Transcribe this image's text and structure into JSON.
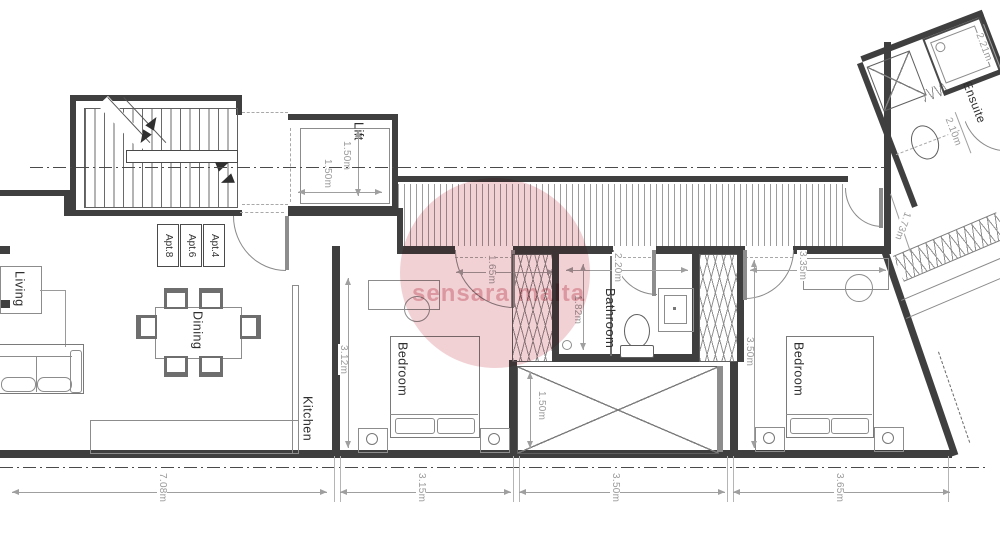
{
  "labels": {
    "lift": "Lift",
    "living": "Living",
    "dining": "Dining",
    "kitchen": "Kitchen",
    "bedroom1": "Bedroom",
    "bedroom2": "Bedroom",
    "bathroom": "Bathroom",
    "ensuite": "Ensuite",
    "apt": [
      "Apt.8",
      "Apt.6",
      "Apt.4"
    ]
  },
  "dimensions": {
    "lift_v": "1.50m",
    "lift_h": "1.50m",
    "bed1_door": "1.65m",
    "bed1_depth": "3.12m",
    "bath_width": "2.20m",
    "shower_depth": "1.82m",
    "void_width": "1.50m",
    "bed2_top": "3.35m",
    "bed2_depth": "3.50m",
    "ensuite_a": "2.21m",
    "ensuite_b": "2.10m",
    "terrace": "1.73m",
    "bottom": [
      "7.08m",
      "3.15m",
      "3.50m",
      "3.65m"
    ]
  },
  "watermark": {
    "text": "sensara malta",
    "color": "#e2a2aa"
  },
  "colors": {
    "wall": "#3f3f3f",
    "furniture": "#8c8c8c",
    "dim": "#9f9f9f"
  }
}
